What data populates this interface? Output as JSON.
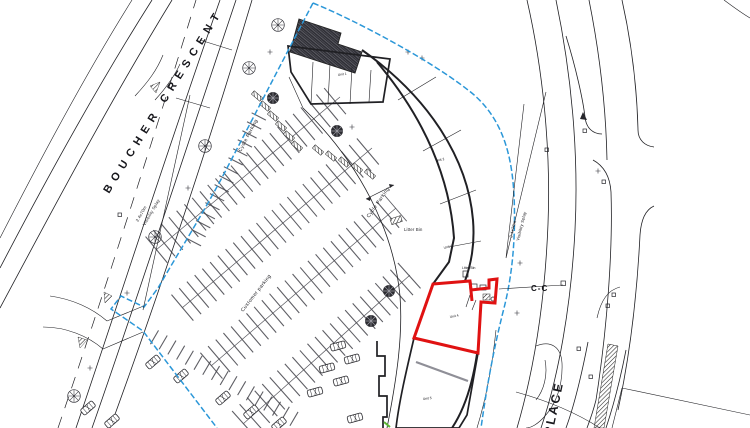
{
  "plan": {
    "street_primary": "BOUCHER CRESCENT",
    "street_secondary": "PLACE",
    "customer_parking": "Customer parking",
    "cycle_parking": "Cycle Parking",
    "visibility_splay_dim": "2.4x70m",
    "visibility_splay_text": "Visibility Splay",
    "litter_bin": "Litter Bin",
    "section_marker": "C-C",
    "units": [
      "Unit 1",
      "Unit 2",
      "Unit 3",
      "Unit 4",
      "Unit 5"
    ]
  },
  "colors": {
    "boundary": "#2b97d8",
    "highlight": "#e01212",
    "ink": "#202024",
    "green": "#5cb832"
  }
}
